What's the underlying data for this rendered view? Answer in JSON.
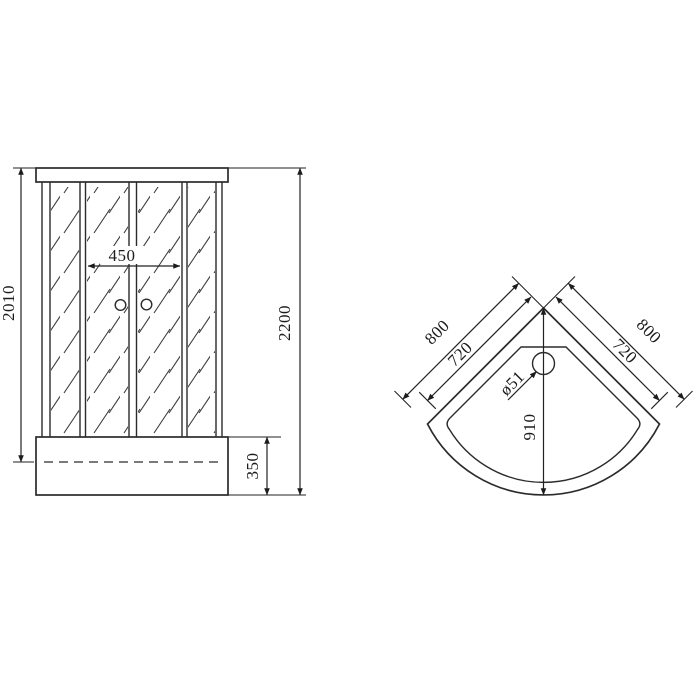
{
  "drawing": {
    "title": "corner shower cabin dimension drawing",
    "colors": {
      "line": "#2b2b2b",
      "background": "#ffffff"
    },
    "front_view": {
      "labels": {
        "glass_height": "2010",
        "door_opening_width": "450",
        "total_height": "2200",
        "tray_height": "350"
      }
    },
    "top_view": {
      "labels": {
        "left_outer_side": "800",
        "right_outer_side": "800",
        "left_inner_side": "720",
        "right_inner_side": "720",
        "drain_diameter": "ø51",
        "front_depth": "910"
      }
    }
  }
}
